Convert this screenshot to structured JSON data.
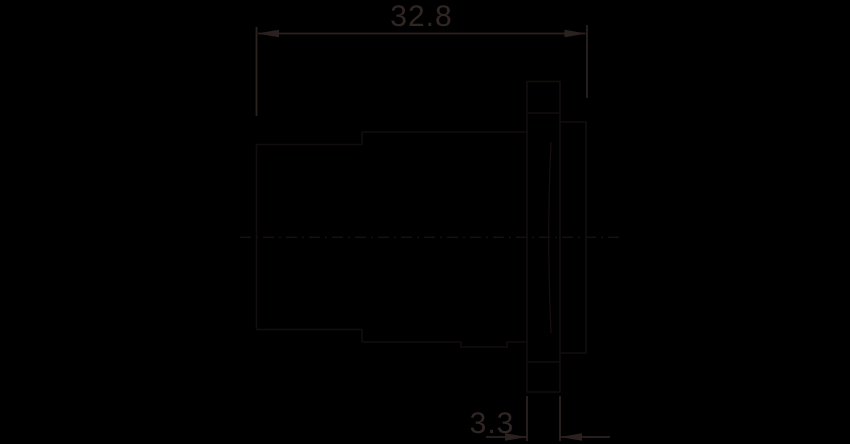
{
  "dimensions": {
    "overall_length": "32.8",
    "flange_thickness": "3.3"
  },
  "colors": {
    "background": "#000000",
    "part_outline": "#120e0d",
    "gasket_curve": "#17100e",
    "centerline": "#161110",
    "dimension_lines": "#2b2220",
    "dimension_text": "#302624"
  }
}
